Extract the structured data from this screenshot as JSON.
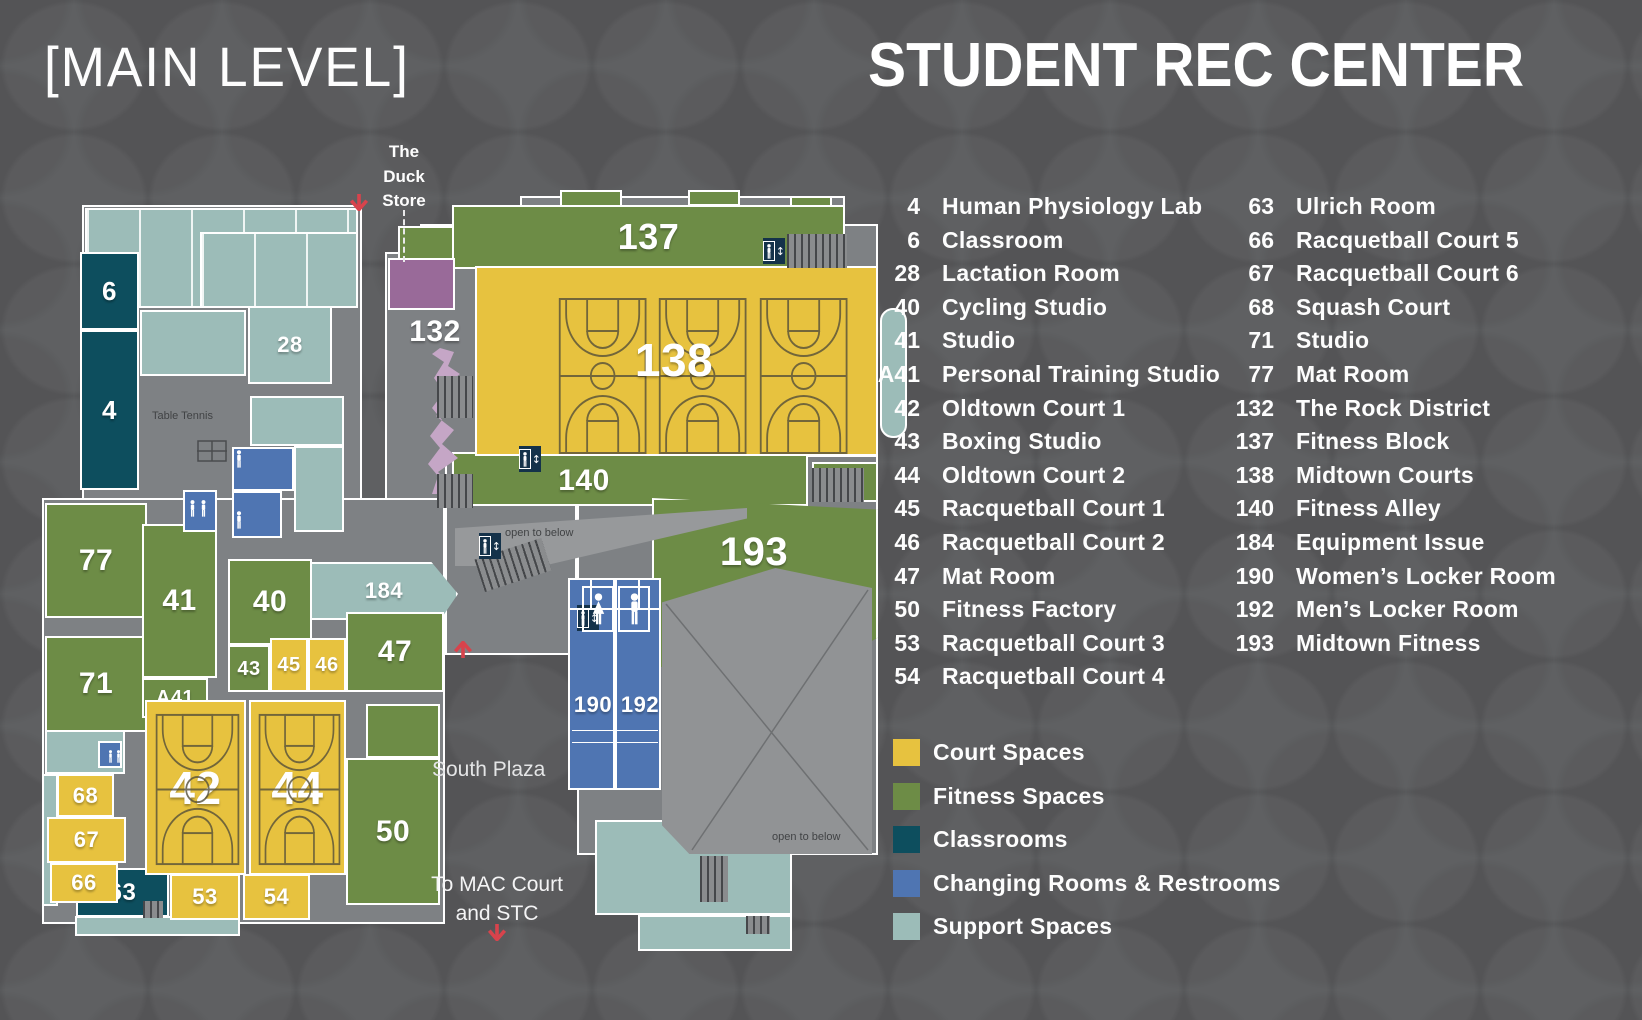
{
  "header": {
    "level_title": "[MAIN LEVEL]",
    "building_title": "STUDENT REC CENTER"
  },
  "annotations": {
    "duck_store": [
      "The",
      "Duck",
      "Store"
    ],
    "table_tennis": "Table Tennis",
    "open_to_below": "open to below",
    "south_plaza": "South Plaza",
    "to_mac": [
      "To MAC Court",
      "and STC"
    ]
  },
  "directory": {
    "col1": [
      {
        "num": "4",
        "name": "Human Physiology Lab"
      },
      {
        "num": "6",
        "name": "Classroom"
      },
      {
        "num": "28",
        "name": "Lactation Room"
      },
      {
        "num": "40",
        "name": "Cycling Studio"
      },
      {
        "num": "41",
        "name": "Studio"
      },
      {
        "num": "A41",
        "name": "Personal Training Studio"
      },
      {
        "num": "42",
        "name": "Oldtown Court 1"
      },
      {
        "num": "43",
        "name": "Boxing Studio"
      },
      {
        "num": "44",
        "name": "Oldtown Court 2"
      },
      {
        "num": "45",
        "name": "Racquetball Court 1"
      },
      {
        "num": "46",
        "name": "Racquetball Court 2"
      },
      {
        "num": "47",
        "name": "Mat Room"
      },
      {
        "num": "50",
        "name": "Fitness Factory"
      },
      {
        "num": "53",
        "name": "Racquetball Court 3"
      },
      {
        "num": "54",
        "name": "Racquetball Court 4"
      }
    ],
    "col2": [
      {
        "num": "63",
        "name": "Ulrich Room"
      },
      {
        "num": "66",
        "name": "Racquetball Court 5"
      },
      {
        "num": "67",
        "name": "Racquetball Court 6"
      },
      {
        "num": "68",
        "name": "Squash Court"
      },
      {
        "num": "71",
        "name": "Studio"
      },
      {
        "num": "77",
        "name": "Mat Room"
      },
      {
        "num": "132",
        "name": "The Rock District"
      },
      {
        "num": "137",
        "name": "Fitness Block"
      },
      {
        "num": "138",
        "name": "Midtown Courts"
      },
      {
        "num": "140",
        "name": "Fitness Alley"
      },
      {
        "num": "184",
        "name": "Equipment Issue"
      },
      {
        "num": "190",
        "name": "Women’s Locker Room"
      },
      {
        "num": "192",
        "name": "Men’s Locker Room"
      },
      {
        "num": "193",
        "name": "Midtown Fitness"
      }
    ]
  },
  "legend": {
    "items": [
      {
        "label": "Court Spaces",
        "color": "#e7c23f"
      },
      {
        "label": "Fitness Spaces",
        "color": "#6d8c46"
      },
      {
        "label": "Classrooms",
        "color": "#0d4e5e"
      },
      {
        "label": "Changing Rooms & Restrooms",
        "color": "#4f75b2"
      },
      {
        "label": "Support Spaces",
        "color": "#9cbcb8"
      }
    ]
  },
  "map": {
    "rooms": [
      {
        "c": "support",
        "x": 85,
        "y": 208,
        "w": 273,
        "h": 100,
        "sub": 1
      },
      {
        "c": "support",
        "x": 200,
        "y": 232,
        "w": 158,
        "h": 76,
        "sub": 1
      },
      {
        "c": "support",
        "x": 140,
        "y": 310,
        "w": 106,
        "h": 66
      },
      {
        "i": "28",
        "c": "support",
        "x": 248,
        "y": 306,
        "w": 84,
        "h": 78,
        "f": 22
      },
      {
        "c": "support",
        "x": 250,
        "y": 396,
        "w": 94,
        "h": 50
      },
      {
        "c": "support",
        "x": 294,
        "y": 446,
        "w": 50,
        "h": 86
      },
      {
        "i": "184",
        "c": "support",
        "x": 310,
        "y": 562,
        "w": 148,
        "h": 58,
        "f": 22,
        "clip": "polygon(0 0,82% 0,100% 55%,88% 100%,0 100%)"
      },
      {
        "c": "support",
        "x": 595,
        "y": 820,
        "w": 197,
        "h": 95
      },
      {
        "c": "support",
        "x": 638,
        "y": 915,
        "w": 154,
        "h": 36
      },
      {
        "c": "support",
        "x": 45,
        "y": 730,
        "w": 80,
        "h": 44
      },
      {
        "c": "support",
        "x": 42,
        "y": 774,
        "w": 16,
        "h": 132
      },
      {
        "c": "support",
        "x": 75,
        "y": 916,
        "w": 165,
        "h": 20
      },
      {
        "c": "support",
        "x": 880,
        "y": 308,
        "w": 27,
        "h": 130,
        "r": "13px"
      },
      {
        "i": "6",
        "c": "classroom",
        "x": 80,
        "y": 252,
        "w": 59,
        "h": 78,
        "f": 26
      },
      {
        "i": "4",
        "c": "classroom",
        "x": 80,
        "y": 330,
        "w": 59,
        "h": 160,
        "f": 26
      },
      {
        "i": "63",
        "c": "classroom",
        "x": 76,
        "y": 868,
        "w": 93,
        "h": 49,
        "f": 24
      },
      {
        "c": "fitness",
        "x": 560,
        "y": 190,
        "w": 62,
        "h": 18
      },
      {
        "c": "fitness",
        "x": 688,
        "y": 190,
        "w": 52,
        "h": 16
      },
      {
        "c": "fitness",
        "x": 790,
        "y": 196,
        "w": 42,
        "h": 12
      },
      {
        "c": "fitness",
        "x": 398,
        "y": 226,
        "w": 56,
        "h": 36
      },
      {
        "i": "137",
        "c": "fitness",
        "x": 452,
        "y": 205,
        "w": 393,
        "h": 64,
        "f": 36
      },
      {
        "i": "140",
        "c": "fitness",
        "x": 452,
        "y": 452,
        "w": 356,
        "h": 54,
        "f": 30,
        "lxy": [
          130,
          27
        ]
      },
      {
        "i": "193",
        "c": "fitness",
        "x": 652,
        "y": 498,
        "w": 226,
        "h": 194,
        "f": 40,
        "lxy": [
          100,
          52
        ],
        "clip": "polygon(0 0,100% 6%,100% 72%,55% 100%,0 86%)"
      },
      {
        "c": "fitness",
        "x": 812,
        "y": 462,
        "w": 66,
        "h": 40
      },
      {
        "i": "77",
        "c": "fitness",
        "x": 45,
        "y": 503,
        "w": 102,
        "h": 115,
        "f": 30
      },
      {
        "i": "71",
        "c": "fitness",
        "x": 45,
        "y": 636,
        "w": 102,
        "h": 96,
        "f": 30
      },
      {
        "i": "41",
        "c": "fitness",
        "x": 142,
        "y": 524,
        "w": 75,
        "h": 154,
        "f": 30
      },
      {
        "i": "A41",
        "c": "fitness",
        "x": 142,
        "y": 678,
        "w": 66,
        "h": 40,
        "f": 20
      },
      {
        "i": "40",
        "c": "fitness",
        "x": 228,
        "y": 559,
        "w": 84,
        "h": 86,
        "f": 30
      },
      {
        "i": "43",
        "c": "fitness",
        "x": 228,
        "y": 645,
        "w": 42,
        "h": 47,
        "f": 20
      },
      {
        "i": "47",
        "c": "fitness",
        "x": 346,
        "y": 612,
        "w": 98,
        "h": 80,
        "f": 30
      },
      {
        "c": "fitness",
        "x": 366,
        "y": 704,
        "w": 74,
        "h": 54
      },
      {
        "i": "50",
        "c": "fitness",
        "x": 346,
        "y": 758,
        "w": 94,
        "h": 147,
        "f": 30
      },
      {
        "i": "138",
        "c": "court",
        "x": 475,
        "y": 266,
        "w": 403,
        "h": 190,
        "f": 46,
        "lxy": [
          197,
          92
        ],
        "cb": [
          80,
          28,
          292,
          160,
          3
        ]
      },
      {
        "i": "42",
        "c": "court",
        "x": 145,
        "y": 700,
        "w": 101,
        "h": 175,
        "f": 46,
        "cb": [
          7,
          10,
          87,
          155,
          1
        ]
      },
      {
        "i": "44",
        "c": "court",
        "x": 249,
        "y": 700,
        "w": 97,
        "h": 175,
        "f": 46,
        "cb": [
          6,
          10,
          85,
          155,
          1
        ]
      },
      {
        "i": "45",
        "c": "court",
        "x": 270,
        "y": 638,
        "w": 38,
        "h": 54,
        "f": 20
      },
      {
        "i": "46",
        "c": "court",
        "x": 308,
        "y": 638,
        "w": 38,
        "h": 54,
        "f": 20
      },
      {
        "i": "53",
        "c": "court",
        "x": 170,
        "y": 874,
        "w": 70,
        "h": 46,
        "f": 22
      },
      {
        "i": "54",
        "c": "court",
        "x": 243,
        "y": 874,
        "w": 67,
        "h": 46,
        "f": 22
      },
      {
        "i": "68",
        "c": "court",
        "x": 57,
        "y": 774,
        "w": 57,
        "h": 43,
        "f": 22
      },
      {
        "i": "67",
        "c": "court",
        "x": 47,
        "y": 817,
        "w": 79,
        "h": 46,
        "f": 22
      },
      {
        "i": "66",
        "c": "court",
        "x": 50,
        "y": 863,
        "w": 68,
        "h": 40,
        "f": 22
      },
      {
        "i": "190",
        "c": "changing",
        "x": 568,
        "y": 578,
        "w": 47,
        "h": 212,
        "f": 22,
        "lxy": [
          23,
          125
        ]
      },
      {
        "i": "192",
        "c": "changing",
        "x": 615,
        "y": 578,
        "w": 46,
        "h": 212,
        "f": 22,
        "lxy": [
          23,
          125
        ]
      },
      {
        "c": "changing",
        "x": 232,
        "y": 447,
        "w": 62,
        "h": 44
      },
      {
        "c": "changing",
        "x": 232,
        "y": 491,
        "w": 50,
        "h": 47
      },
      {
        "c": "changing",
        "x": 183,
        "y": 490,
        "w": 34,
        "h": 42
      },
      {
        "c": "changing",
        "x": 98,
        "y": 741,
        "w": 24,
        "h": 27
      },
      {
        "c": "duck",
        "x": 388,
        "y": 258,
        "w": 67,
        "h": 52
      },
      {
        "i": "132",
        "c": "zone",
        "x": 390,
        "y": 312,
        "w": 90,
        "h": 40,
        "f": 30
      }
    ]
  }
}
